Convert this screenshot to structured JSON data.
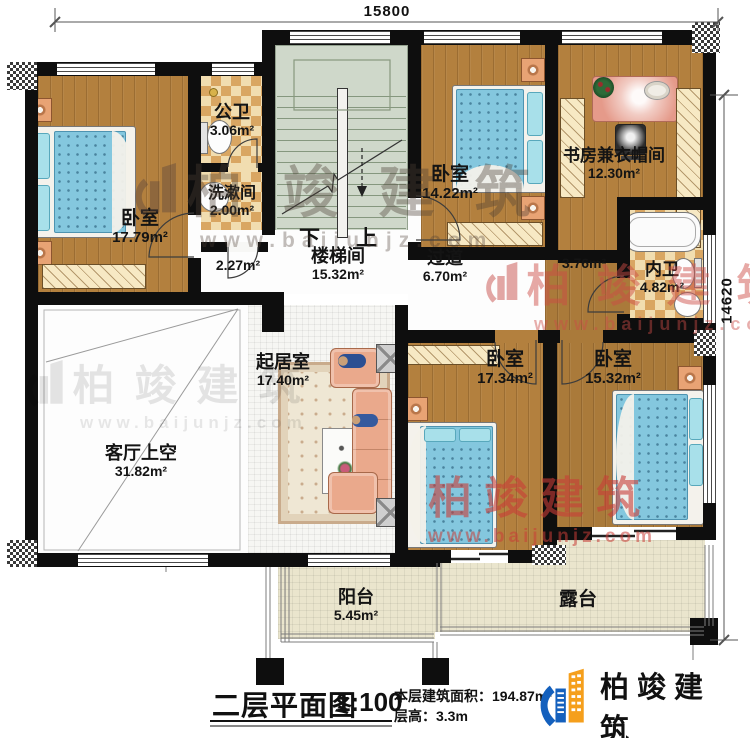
{
  "dimensions": {
    "top": "15800",
    "right": "14620"
  },
  "stairs": {
    "down": "下",
    "up": "上"
  },
  "rooms": [
    {
      "id": "bedroom-tl",
      "name": "卧室",
      "area": "17.79m²"
    },
    {
      "id": "public-bath",
      "name": "公卫",
      "area": "3.06m²"
    },
    {
      "id": "washroom",
      "name": "洗漱间",
      "area": "2.00m²"
    },
    {
      "id": "stairwell",
      "name": "楼梯间",
      "area": "15.32m²"
    },
    {
      "id": "hallway",
      "name": "过道",
      "area": "6.70m²"
    },
    {
      "id": "bedroom-tm",
      "name": "卧室",
      "area": "14.22m²"
    },
    {
      "id": "study-cloakroom",
      "name": "书房兼衣帽间",
      "area": "12.30m²"
    },
    {
      "id": "master-bath",
      "name": "内卫",
      "area": "4.82m²"
    },
    {
      "id": "living-void",
      "name": "客厅上空",
      "area": "31.82m²"
    },
    {
      "id": "family-room",
      "name": "起居室",
      "area": "17.40m²"
    },
    {
      "id": "bedroom-bm",
      "name": "卧室",
      "area": "17.34m²"
    },
    {
      "id": "bedroom-br",
      "name": "卧室",
      "area": "15.32m²"
    },
    {
      "id": "balcony",
      "name": "阳台",
      "area": "5.45m²"
    },
    {
      "id": "terrace",
      "name": "露台",
      "area": ""
    }
  ],
  "area_labels": {
    "hall_small": "2.27m²",
    "corridor_small": "3.76m²"
  },
  "title_block": {
    "title": "二层平面图",
    "scale": "1:100",
    "area_line": "本层建筑面积：194.87m²",
    "height_line": "层高：3.3m"
  },
  "branding": {
    "company": "柏竣建筑",
    "website": "www.baijunjz.com"
  }
}
